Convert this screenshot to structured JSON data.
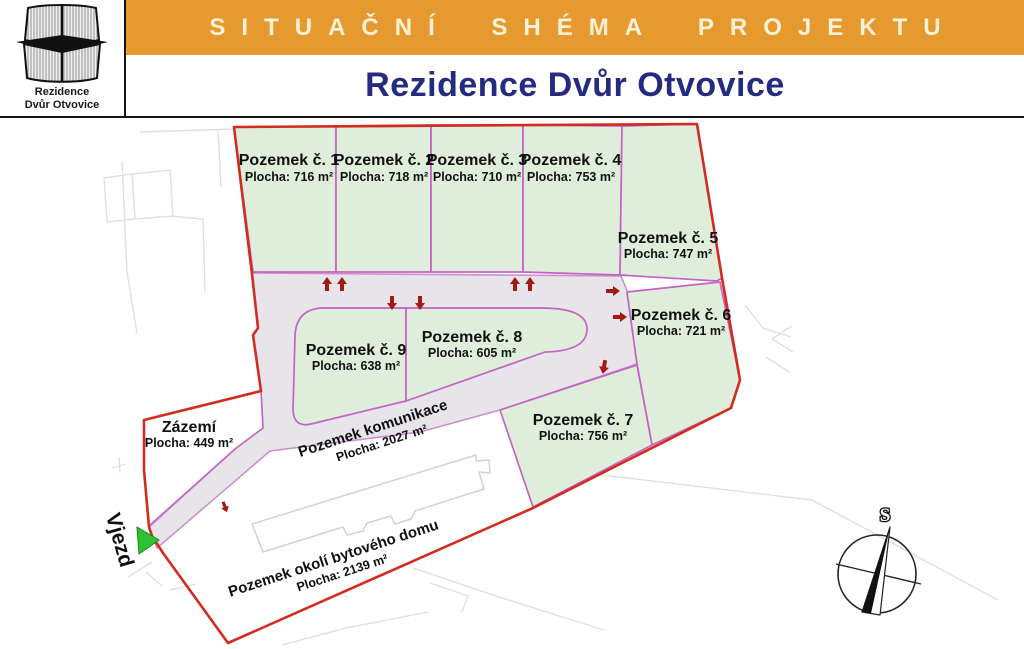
{
  "header": {
    "schema_title": "SITUAČNÍ SHÉMA PROJEKTU",
    "project_title": "Rezidence Dvůr Otvovice"
  },
  "logo": {
    "line1": "Rezidence",
    "line2": "Dvůr Otvovice"
  },
  "map": {
    "plots": [
      {
        "name": "Pozemek č. 1",
        "area": "Plocha: 716 m²"
      },
      {
        "name": "Pozemek č. 2",
        "area": "Plocha: 718 m²"
      },
      {
        "name": "Pozemek č. 3",
        "area": "Plocha: 710 m²"
      },
      {
        "name": "Pozemek č. 4",
        "area": "Plocha: 753 m²"
      },
      {
        "name": "Pozemek č. 5",
        "area": "Plocha: 747 m²"
      },
      {
        "name": "Pozemek č. 6",
        "area": "Plocha: 721 m²"
      },
      {
        "name": "Pozemek č. 7",
        "area": "Plocha: 756 m²"
      },
      {
        "name": "Pozemek č. 8",
        "area": "Plocha: 605 m²"
      },
      {
        "name": "Pozemek č. 9",
        "area": "Plocha: 638 m²"
      }
    ],
    "zazemi": {
      "name": "Zázemí",
      "area": "Plocha: 449 m²"
    },
    "komunikace": {
      "name": "Pozemek komunikace",
      "area": "Plocha: 2027 m²"
    },
    "okoli": {
      "name": "Pozemek okolí bytového domu",
      "area": "Plocha: 2139 m²"
    },
    "entrance_label": "Vjezd",
    "compass_north_label": "S"
  },
  "colors": {
    "header_orange": "#E6992F",
    "header_text_cream": "#FBF2D6",
    "title_navy": "#252B7E",
    "plot_green": "#DFEEDA",
    "plot_border_magenta": "#C463C4",
    "boundary_red": "#D22B1F",
    "road_gray": "#E7E5E9",
    "arrow_dark_red": "#A21A14",
    "entrance_green": "#2FC12F"
  }
}
